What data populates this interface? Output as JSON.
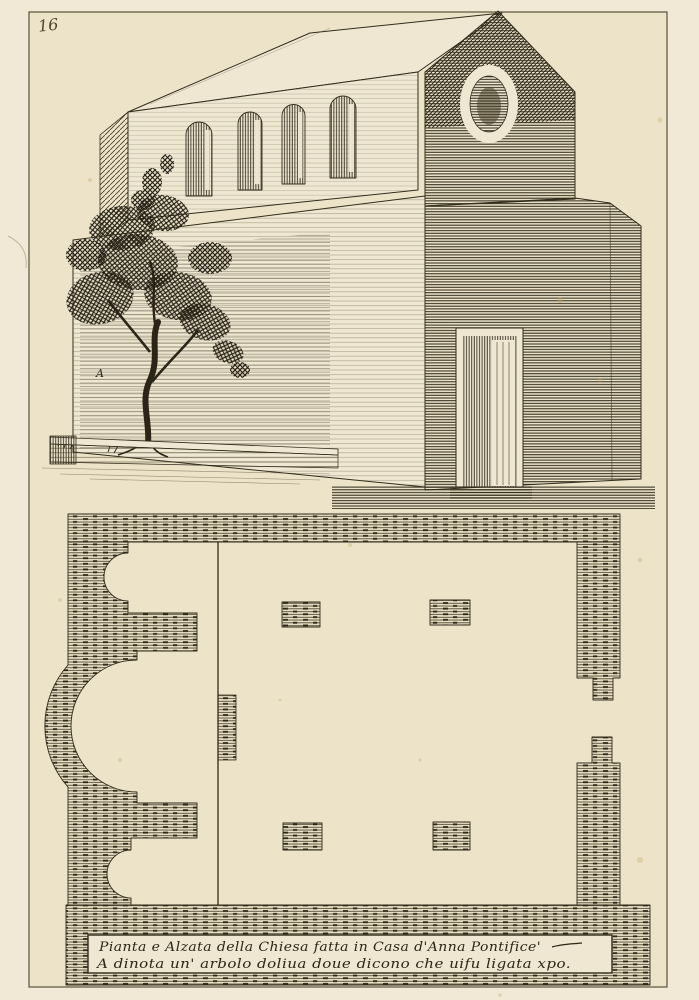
{
  "print": {
    "plate_number": "16",
    "wall_letter": "A",
    "caption_line1": "Pianta e Alzata della Chiesa fatta in Casa d'Anna Pontifice'",
    "caption_line2": "A dinota un' arbolo doliua doue dicono che uifu ligata xpo.",
    "colors": {
      "paper": "#f1e9d6",
      "plate_tone": "#ece3c9",
      "ink": "#322c1b",
      "hatch_brown": "#3f3722"
    }
  }
}
